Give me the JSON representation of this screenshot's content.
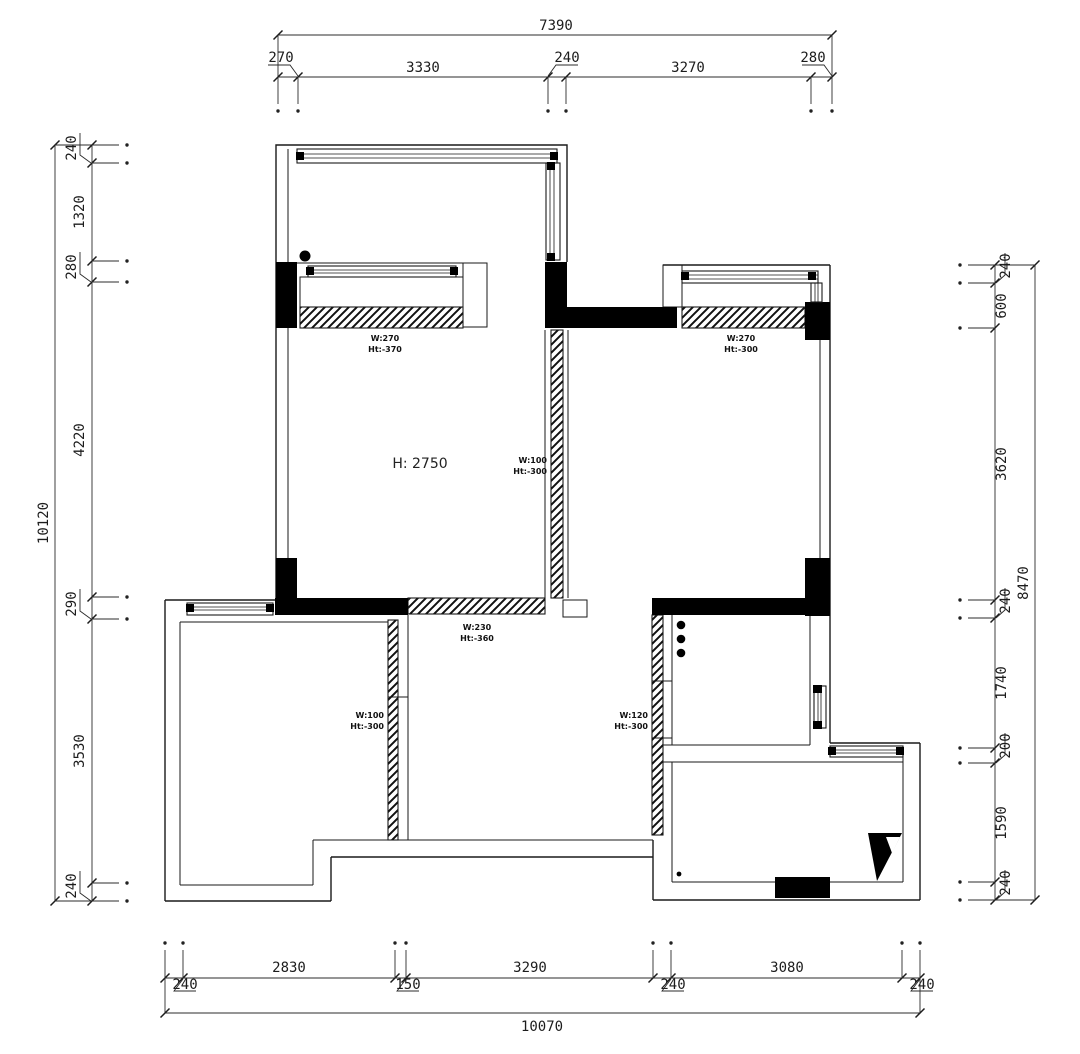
{
  "plan": {
    "ceiling_height_label": "H: 2750",
    "wall_labels": [
      {
        "w": "W:270",
        "ht": "Ht:-370"
      },
      {
        "w": "W:270",
        "ht": "Ht:-300"
      },
      {
        "w": "W:100",
        "ht": "Ht:-300"
      },
      {
        "w": "W:230",
        "ht": "Ht:-360"
      },
      {
        "w": "W:100",
        "ht": "Ht:-300"
      },
      {
        "w": "W:120",
        "ht": "Ht:-300"
      }
    ]
  },
  "dimensions": {
    "top": {
      "total": "7390",
      "segments": [
        "270",
        "3330",
        "240",
        "3270",
        "280"
      ]
    },
    "left": {
      "total": "10120",
      "segments": [
        "240",
        "1320",
        "280",
        "4220",
        "290",
        "3530",
        "240"
      ]
    },
    "right": {
      "total": "8470",
      "segments": [
        "240",
        "600",
        "3620",
        "240",
        "1740",
        "200",
        "1590",
        "240"
      ]
    },
    "bottom": {
      "total": "10070",
      "segments": [
        "240",
        "2830",
        "150",
        "3290",
        "240",
        "3080",
        "240"
      ]
    }
  },
  "colors": {
    "line": "#1a1a1a",
    "solid_wall": "#000000",
    "background": "#ffffff"
  }
}
